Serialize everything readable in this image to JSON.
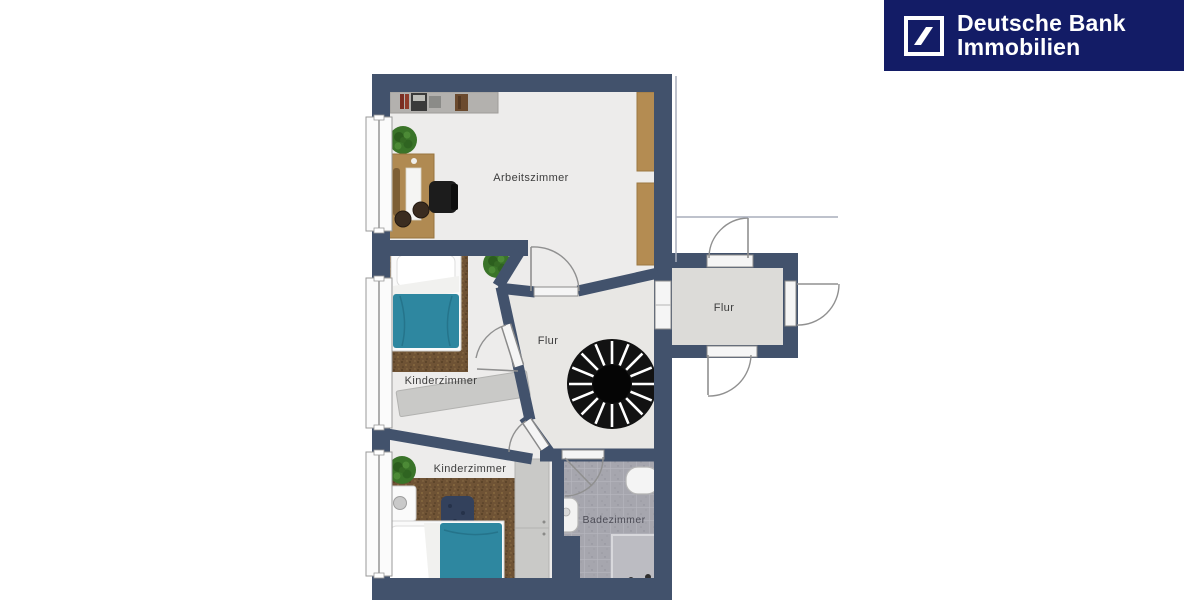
{
  "brand": {
    "line1": "Deutsche Bank",
    "line2": "Immobilien",
    "background_color": "#131c66",
    "text_color": "#ffffff",
    "logo_icon": "deutsche-bank-slash-square-icon"
  },
  "floor_plan": {
    "type": "apartment-floor-plan-top-view",
    "wall_color": "#42526c",
    "floor_color": "#edeceb",
    "hall_floor_color": "#e8e7e4",
    "east_hall_floor_color": "#dcdbd8",
    "bathroom_tile_color": "#a6a6ae",
    "carpet_color": "#6f5335",
    "bed_cover_color": "#2e87a0",
    "wood_color": "#b48c52",
    "rooms": [
      {
        "id": "arbeitszimmer",
        "label": "Arbeitszimmer"
      },
      {
        "id": "kinderzimmer-mitte",
        "label": "Kinderzimmer"
      },
      {
        "id": "flur-mitte",
        "label": "Flur"
      },
      {
        "id": "flur-ost",
        "label": "Flur"
      },
      {
        "id": "kinderzimmer-sued",
        "label": "Kinderzimmer"
      },
      {
        "id": "badezimmer",
        "label": "Badezimmer"
      }
    ],
    "features": [
      {
        "name": "spiral-staircase",
        "color": "#121212"
      },
      {
        "name": "single-bed",
        "room": "kinderzimmer-mitte",
        "cover_color": "#2e87a0"
      },
      {
        "name": "single-bed",
        "room": "kinderzimmer-sued",
        "cover_color": "#2e87a0"
      },
      {
        "name": "desk-with-office-chair",
        "room": "arbeitszimmer"
      },
      {
        "name": "wall-shelf",
        "room": "arbeitszimmer"
      },
      {
        "name": "wardrobe",
        "room": "arbeitszimmer",
        "color": "#b48c52"
      },
      {
        "name": "sideboard",
        "room": "kinderzimmer-mitte",
        "color": "#c9c9c7"
      },
      {
        "name": "wardrobe",
        "room": "kinderzimmer-sued",
        "color": "#c9c9c7"
      },
      {
        "name": "nightstand-with-lamp",
        "room": "kinderzimmer-sued"
      },
      {
        "name": "potted-plant",
        "count": 3,
        "color": "#3a7429"
      },
      {
        "name": "bathtub",
        "room": "badezimmer"
      },
      {
        "name": "washbasin",
        "room": "badezimmer"
      },
      {
        "name": "shower",
        "room": "badezimmer"
      },
      {
        "name": "window",
        "count": 3,
        "wall": "west"
      },
      {
        "name": "door-swing",
        "count": 8
      }
    ]
  }
}
